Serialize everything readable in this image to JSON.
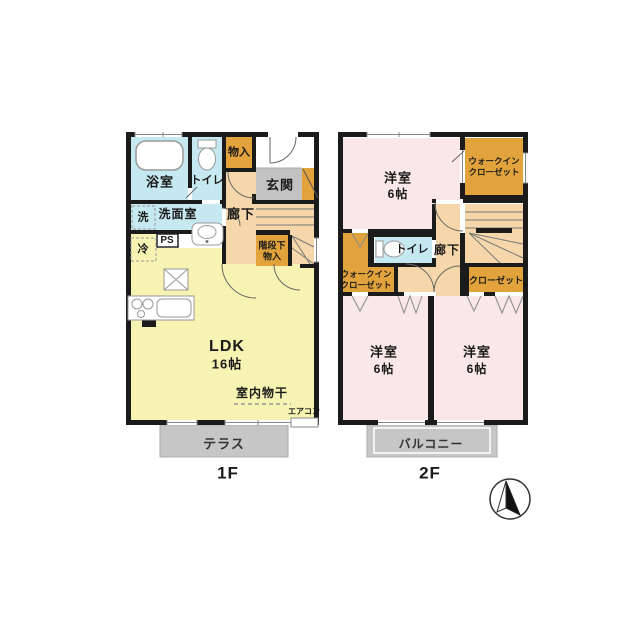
{
  "floor1": {
    "floor_label": "1F",
    "bath": "浴室",
    "toilet": "トイレ",
    "storage": "物入",
    "entrance": "玄関",
    "washroom": "洗面室",
    "washer": "洗",
    "ps": "PS",
    "fridge": "冷",
    "hallway": "廊下",
    "under_stairs_line1": "階段下",
    "under_stairs_line2": "物入",
    "ldk_name": "LDK",
    "ldk_size": "16帖",
    "indoor_drying": "室内物干",
    "aircon": "エアコン",
    "terrace": "テラス"
  },
  "floor2": {
    "floor_label": "2F",
    "bedroom_top_name": "洋室",
    "bedroom_top_size": "6帖",
    "wic_right_line1": "ウォークイン",
    "wic_right_line2": "クローゼット",
    "toilet": "トイレ",
    "hallway": "廊下",
    "wic_left_line1": "ウォークイン",
    "wic_left_line2": "クローゼット",
    "closet": "クローゼット",
    "bedroom_left_name": "洋室",
    "bedroom_left_size": "6帖",
    "bedroom_right_name": "洋室",
    "bedroom_right_size": "6帖",
    "balcony": "バルコニー"
  },
  "colors": {
    "wall": "#1b1b1b",
    "water_blue": "#c6e8f1",
    "closet_orange": "#e2a33c",
    "hallway_peach": "#f6d7ab",
    "ldk_yellow": "#f7f3b2",
    "bedroom_pink": "#fae8e8",
    "entrance_gray": "#c2c2c2",
    "terrace_gray": "#c6c6c6"
  }
}
